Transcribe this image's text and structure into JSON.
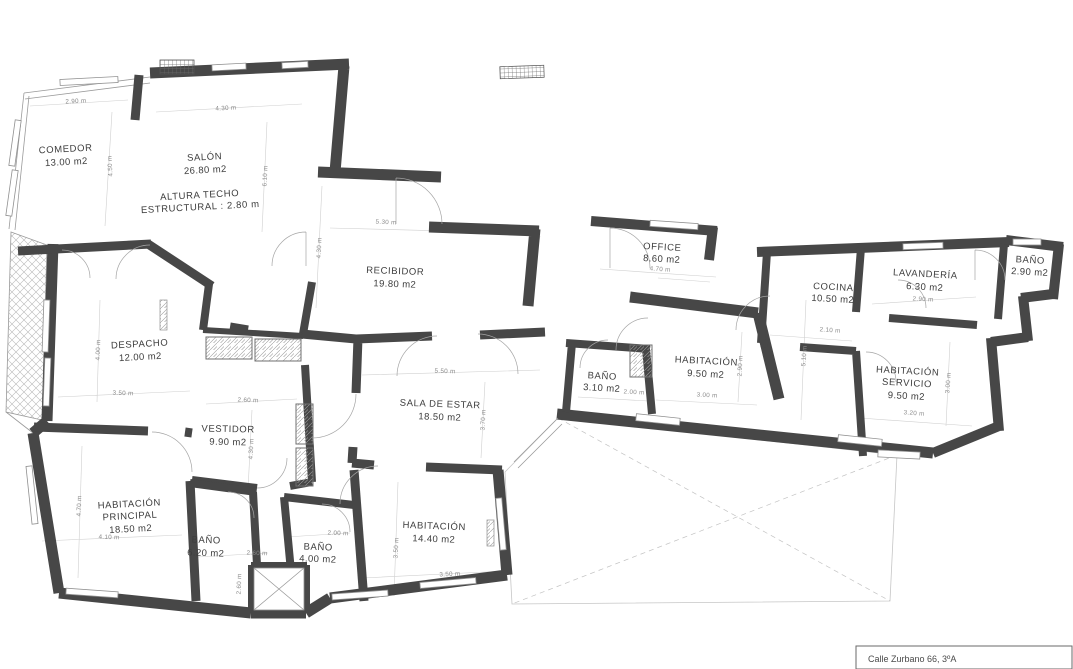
{
  "document": {
    "type": "apartment floor plan",
    "address": "Calle Zurbano 66, 3ºA"
  },
  "notes": {
    "ceiling_line1": "ALTURA TECHO",
    "ceiling_line2": "ESTRUCTURAL : 2.80 m"
  },
  "rooms": {
    "comedor": {
      "name": "COMEDOR",
      "area": "13.00 m2"
    },
    "salon": {
      "name": "SALÓN",
      "area": "26.80 m2"
    },
    "recibidor": {
      "name": "RECIBIDOR",
      "area": "19.80 m2"
    },
    "office": {
      "name": "OFFICE",
      "area": "8.60 m2"
    },
    "cocina": {
      "name": "COCINA",
      "area": "10.50 m2"
    },
    "lavanderia": {
      "name": "LAVANDERÍA",
      "area": "6.30 m2"
    },
    "bano_superior": {
      "name": "BAÑO",
      "area": "2.90 m2"
    },
    "habitacion_9": {
      "name": "HABITACIÓN",
      "area": "9.50 m2"
    },
    "bano_3": {
      "name": "BAÑO",
      "area": "3.10 m2"
    },
    "hab_servicio": {
      "name1": "HABITACIÓN",
      "name2": "SERVICIO",
      "area": "9.50 m2"
    },
    "despacho": {
      "name": "DESPACHO",
      "area": "12.00 m2"
    },
    "vestidor": {
      "name": "VESTIDOR",
      "area": "9.90 m2"
    },
    "sala_estar": {
      "name": "SALA DE ESTAR",
      "area": "18.50 m2"
    },
    "hab_principal": {
      "name1": "HABITACIÓN",
      "name2": "PRINCIPAL",
      "area": "18.50 m2"
    },
    "bano_6": {
      "name": "BAÑO",
      "area": "6.20 m2"
    },
    "bano_4": {
      "name": "BAÑO",
      "area": "4.00 m2"
    },
    "habitacion_14": {
      "name": "HABITACIÓN",
      "area": "14.40 m2"
    }
  },
  "dims": [
    "2.90 m",
    "4.30 m",
    "4.50 m",
    "6.10 m",
    "5.30 m",
    "4.30 m",
    "4.70 m",
    "2.10 m",
    "5.10 m",
    "2.90 m",
    "3.00 m",
    "2.90 m",
    "2.00 m",
    "3.20 m",
    "3.00 m",
    "4.00 m",
    "3.50 m",
    "2.60 m",
    "4.30 m",
    "5.50 m",
    "3.70 m",
    "4.70 m",
    "4.10 m",
    "2.60 m",
    "2.60 m",
    "2.00 m",
    "3.50 m",
    "3.50 m"
  ],
  "colors": {
    "wall": "#474747",
    "thin_line": "#9a9a9a",
    "guide_line": "#cfcfcf",
    "text": "#3d3d3d",
    "dim_text": "#8b8b8b",
    "background": "#ffffff"
  }
}
